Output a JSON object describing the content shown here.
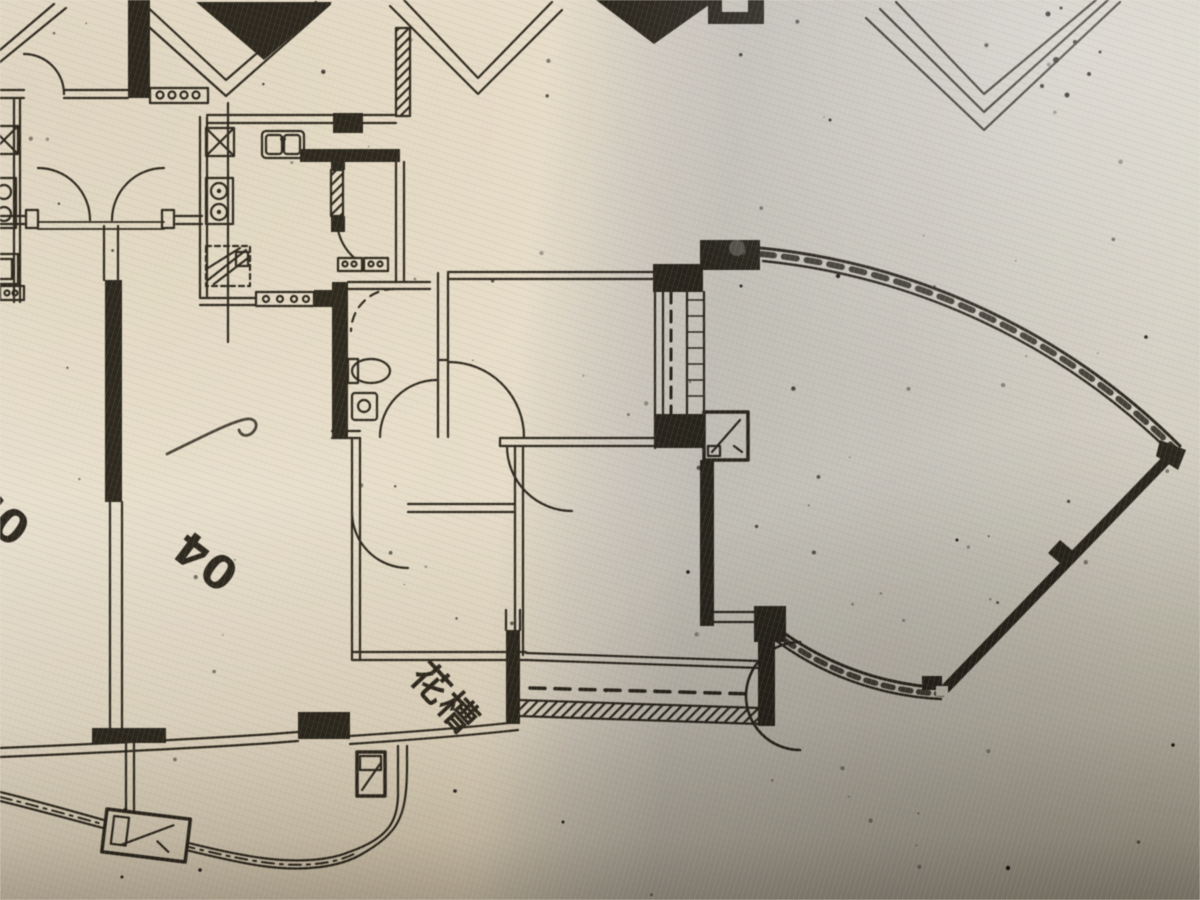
{
  "photo": {
    "description": "Photograph of a printed architectural floor plan: two apartment units with a fan-shaped curved balcony wing",
    "labels": {
      "unit_03": "03",
      "unit_04": "04",
      "planter": "花槽"
    },
    "colors": {
      "ink": "#2f2a20",
      "paper_warm": "#ece4d4",
      "paper_cool_shadow": "#ccd1d8",
      "paper_dark_edge": "#b5b0a7"
    }
  }
}
